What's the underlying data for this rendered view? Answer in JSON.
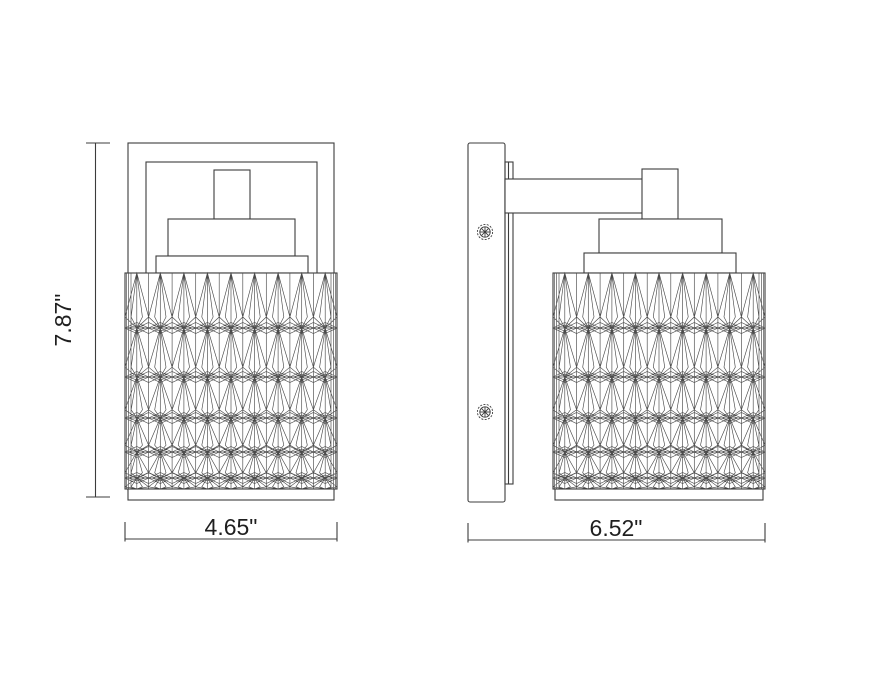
{
  "drawing": {
    "background": "#ffffff",
    "line_color": "#3c3c3c",
    "pattern_line_color": "#4a4a4a",
    "text_color": "#1f1f1f",
    "dimensions": {
      "height": "7.87\"",
      "width": "4.65\"",
      "depth": "6.52\""
    },
    "icons": {
      "screw": "circled-phillips-cross"
    }
  }
}
